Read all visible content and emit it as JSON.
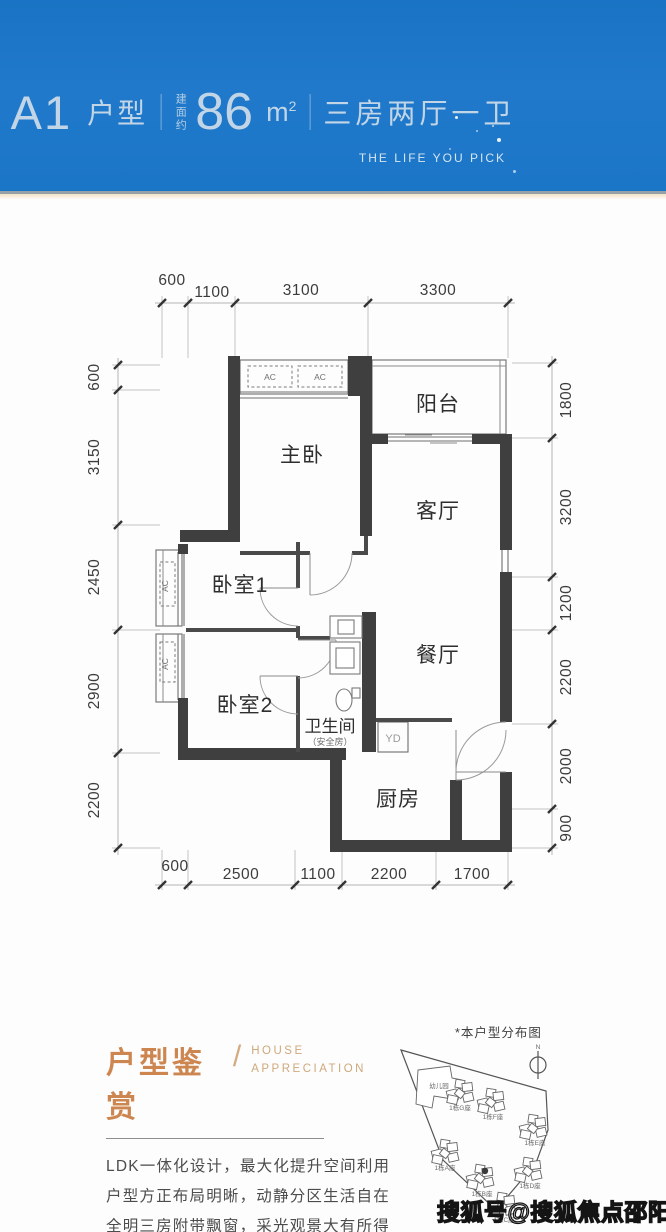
{
  "header": {
    "unit": "A1",
    "unit_suffix": "户型",
    "area_prefix": "建面约",
    "area_value": "86",
    "area_unit_base": "m",
    "area_unit_sup": "2",
    "layout": "三房两厅一卫",
    "tagline": "THE LIFE YOU PICK"
  },
  "plan": {
    "dims_top": [
      "600",
      "1100",
      "3100",
      "3300"
    ],
    "dims_bottom": [
      "600",
      "2500",
      "1100",
      "2200",
      "1700"
    ],
    "dims_left": [
      "600",
      "3150",
      "2450",
      "2900",
      "2200"
    ],
    "dims_right": [
      "1800",
      "3200",
      "1200",
      "2200",
      "2000",
      "900"
    ],
    "rooms": {
      "balcony": "阳台",
      "master": "主卧",
      "living": "客厅",
      "bed1": "卧室1",
      "dining": "餐厅",
      "bed2": "卧室2",
      "bath": "卫生间",
      "bath_sub": "（安全房）",
      "kitchen": "厨房",
      "yd": "YD",
      "ac": "AC"
    }
  },
  "appreciation": {
    "title_cn": "户型鉴赏",
    "divider": "/",
    "title_en_line1": "HOUSE",
    "title_en_line2": "APPRECIATION",
    "lines": [
      "LDK一体化设计，最大化提升空间利用",
      "户型方正布局明晰，动静分区生活自在",
      "全明三房附带飘窗，采光观景大有所得",
      "从容享三分离卫浴，干湿分离舒爽生活"
    ]
  },
  "siteplan": {
    "title": "*本户型分布图",
    "north": "N",
    "kindergarten": "幼儿园",
    "buildings": [
      "1栋G座",
      "1栋F座",
      "1栋E座",
      "1栋A座",
      "1栋B座",
      "1栋D座",
      "1栋C座"
    ]
  },
  "watermark": "搜狐号@搜狐焦点邵阳站",
  "colors": {
    "header_blue": "#1c77c8",
    "accent_tan": "#cd8650",
    "wall": "#3f3f3f"
  }
}
